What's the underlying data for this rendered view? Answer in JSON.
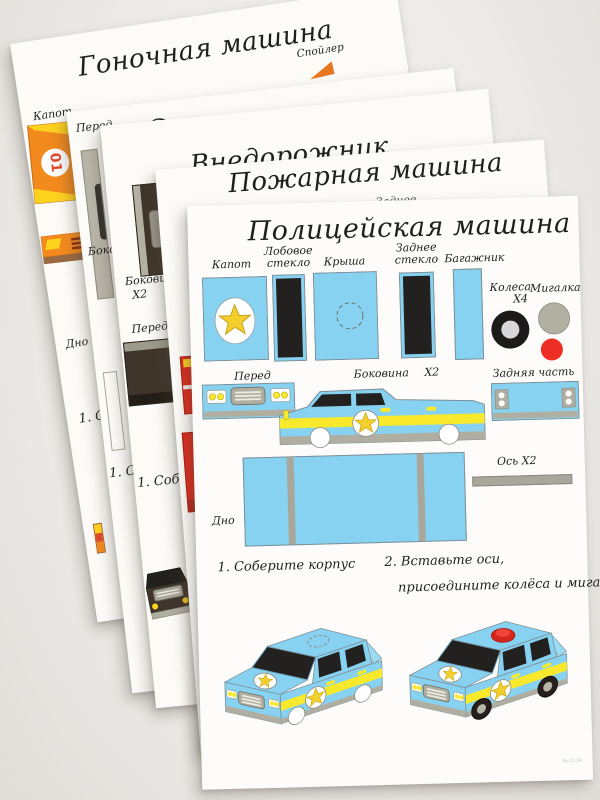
{
  "photo": {
    "background": "#edebe8"
  },
  "colors": {
    "paper": "#fcfbf8",
    "part_blue": "#87d2f0",
    "stripe_yellow": "#f8e92c",
    "window_black": "#23211f",
    "olive_gray": "#a9a79b",
    "bumper_tan": "#b0aea0",
    "wheel_black": "#1d1b19",
    "wheel_hub": "#d7d7db",
    "beacon_gray": "#b2b0a2",
    "beacon_red": "#ee2e24",
    "racing_orange": "#f28a1e",
    "racing_yellow": "#ffd21e",
    "fire_red": "#dd2d1f",
    "suv_brown": "#3f352b"
  },
  "sheets": [
    {
      "title": "Гоночная машина",
      "labels": {
        "spoiler": "Спойлер",
        "hood": "Капот",
        "hood_number": "01",
        "bottom": "Дно",
        "step1": "1. Соберите корпус"
      }
    },
    {
      "title": "Скорая помощь",
      "labels": {
        "front": "Перед",
        "side": "Боковина",
        "step1": "1. Соберите корпус"
      }
    },
    {
      "title": "Внедорожник",
      "labels": {
        "front": "Перед",
        "side": "Боковина",
        "side_qty": "Х2",
        "bottom": "Дно",
        "step1": "1. Соберите корпус"
      }
    },
    {
      "title": "Пожарная машина",
      "labels": {
        "rear_window": "Заднее стекло",
        "trunk": "Багажник"
      }
    },
    {
      "title": "Полицейская машина",
      "parts": {
        "hood": "Капот",
        "windshield": "Лобовое стекло",
        "roof": "Крыша",
        "rear_window": "Заднее стекло",
        "trunk": "Багажник",
        "wheels": "Колеса",
        "wheels_qty": "Х4",
        "beacon": "Мигалка",
        "front": "Перед",
        "side": "Боковина",
        "side_qty": "Х2",
        "rear": "Задняя часть",
        "bottom": "Дно",
        "axle": "Ось Х2"
      },
      "steps": {
        "step1": "1. Соберите корпус",
        "step2_line1": "2. Вставьте оси,",
        "step2_line2": "присоедините колёса и мигалку"
      },
      "footer_code": "№ 2134"
    }
  ]
}
